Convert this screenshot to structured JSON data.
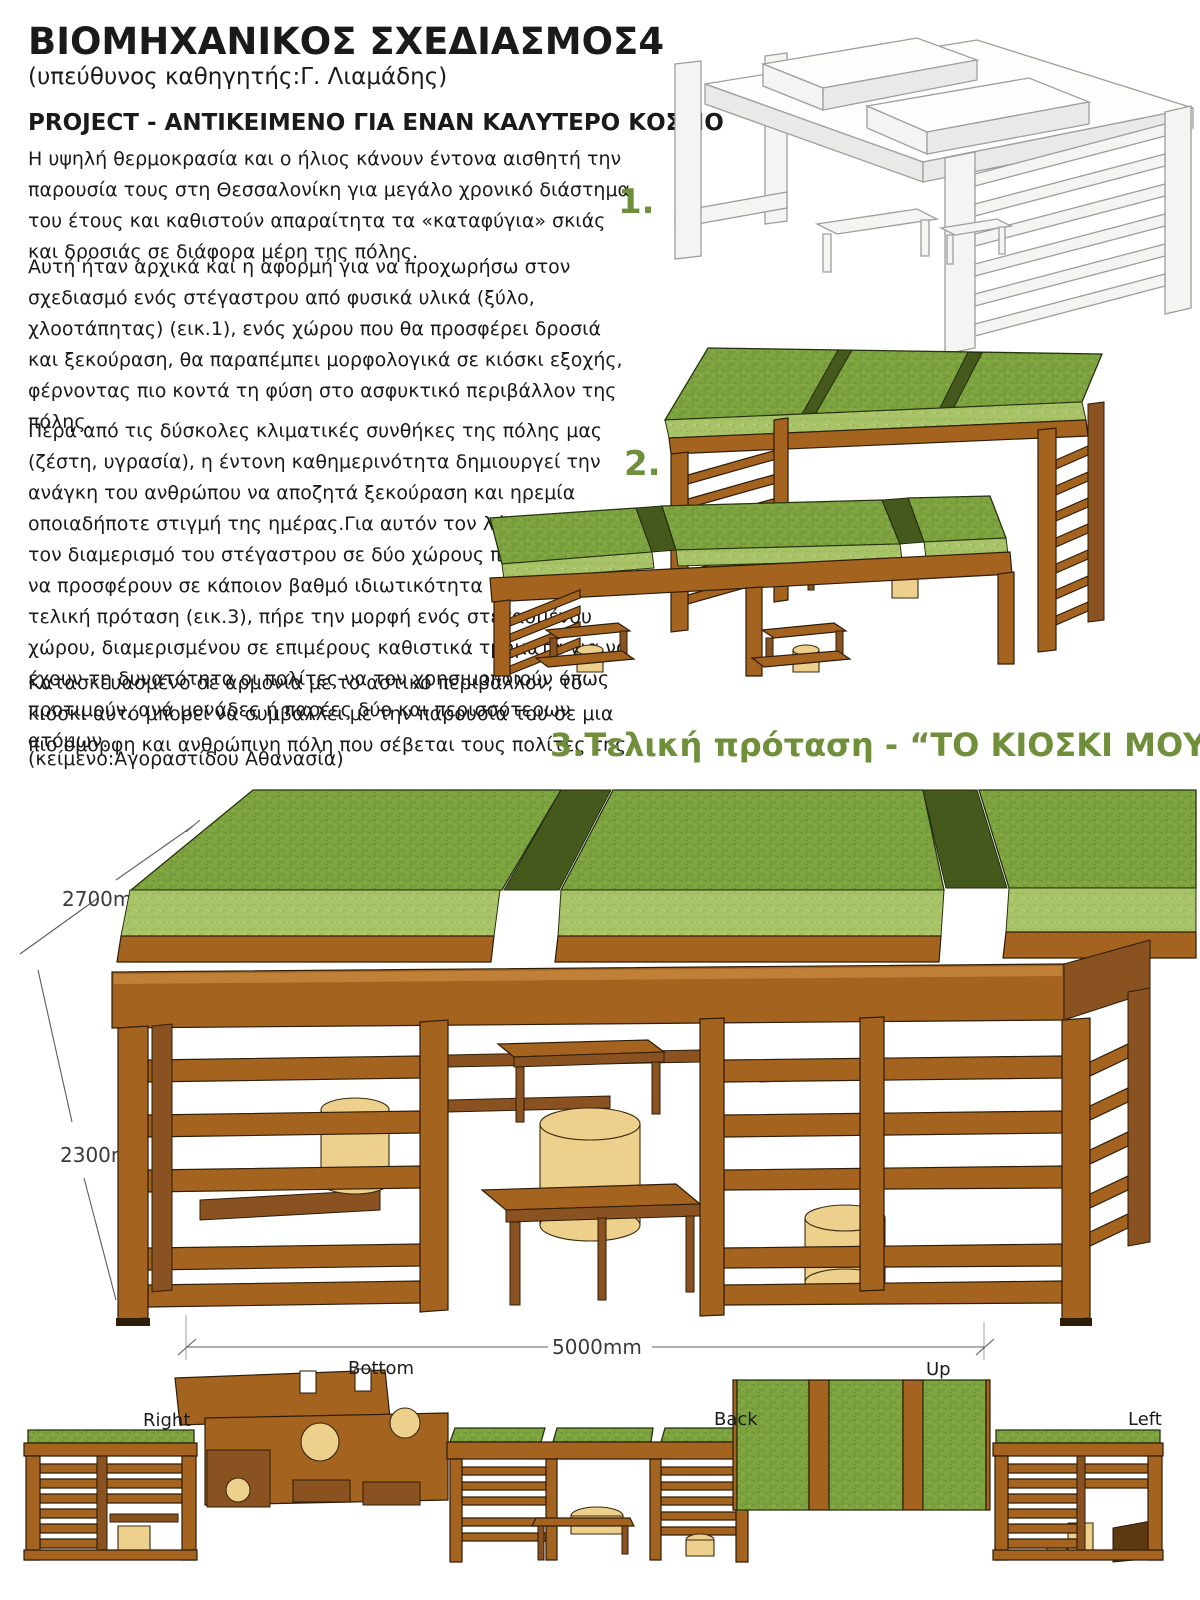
{
  "header": {
    "title": "ΒΙΟΜΗΧΑΝΙΚΟΣ ΣΧΕΔΙΑΣΜΟΣ4",
    "subtitle": "(υπεύθυνος καθηγητής:Γ. Λιαμάδης)",
    "project_heading": "PROJECT - ΑΝΤΙΚΕΙΜΕΝΟ ΓΙΑ ΕΝΑΝ ΚΑΛΥΤΕΡΟ ΚΟΣΜΟ"
  },
  "body": {
    "paragraphs": [
      "Η υψηλή θερμοκρασία και ο ήλιος κάνουν έντονα αισθητή την παρουσία τους στη Θεσσαλονίκη για μεγάλο χρονικό διάστημα του έτους και καθιστούν απαραίτητα τα «καταφύγια» σκιάς και δροσιάς σε διάφορα μέρη της πόλης.",
      "Αυτή ήταν αρχικά και η αφορμή για να προχωρήσω στον σχεδιασμό ενός στέγαστρου από φυσικά υλικά (ξύλο, χλοοτάπητας) (εικ.1), ενός χώρου που θα προσφέρει δροσιά και ξεκούραση, θα παραπέμπει μορφολογικά σε κιόσκι εξοχής, φέρνοντας πιο κοντά τη φύση στο ασφυκτικό περιβάλλον της πόλης.",
      "Πέρα από τις δύσκολες κλιματικές συνθήκες της πόλης μας (ζέστη, υγρασία), η έντονη καθημερινότητα δημιουργεί την ανάγκη του ανθρώπου να αποζητά ξεκούραση και ηρεμία οποιαδήποτε στιγμή της ημέρας.Για αυτόν τον λόγο σκέφτηκα τον διαμερισμό του στέγαστρου σε δύο χώρους προκειμένου να προσφέρουν σε κάποιον βαθμό ιδιωτικότητα (εικ.2).Η τελική πρόταση (εικ.3), πήρε την μορφή ενός στεγασμένου χώρου, διαμερισμένου σε επιμέρους καθιστικά τμήματα για να έχουν τη δυνατότητα οι πολίτες να τον χρησιμοποιούν όπως προτιμούν, ανά μονάδες ή παρέες δύο και περισσότερων ατόμων.",
      "Κατασκευασμένο σε αρμονία με το αστικό περιβάλλον, το κιόσκι αυτό μπορεί να συμβάλλει με την παρουσία του σε μια πιο όμορφη και ανθρώπινη πόλη που σέβεται τους πολίτες της."
    ],
    "credit": "(κείμενο:Αγοραστίδου Αθανασία)"
  },
  "figures": {
    "fig1_label": "1.",
    "fig2_label": "2.",
    "fig3_caption": "3.Τελική πρόταση - “ΤΟ ΚΙΟΣΚΙ ΜΟΥ”"
  },
  "dimensions": {
    "depth": "2700mm",
    "height": "2300mm",
    "width": "5000mm"
  },
  "view_labels": {
    "right": "Right",
    "bottom": "Bottom",
    "back": "Back",
    "up": "Up",
    "left": "Left"
  },
  "colors": {
    "accent_green": "#6f8f3a",
    "grass": "#7ea440",
    "wood": "#a4631f",
    "straw": "#ecd08b"
  }
}
